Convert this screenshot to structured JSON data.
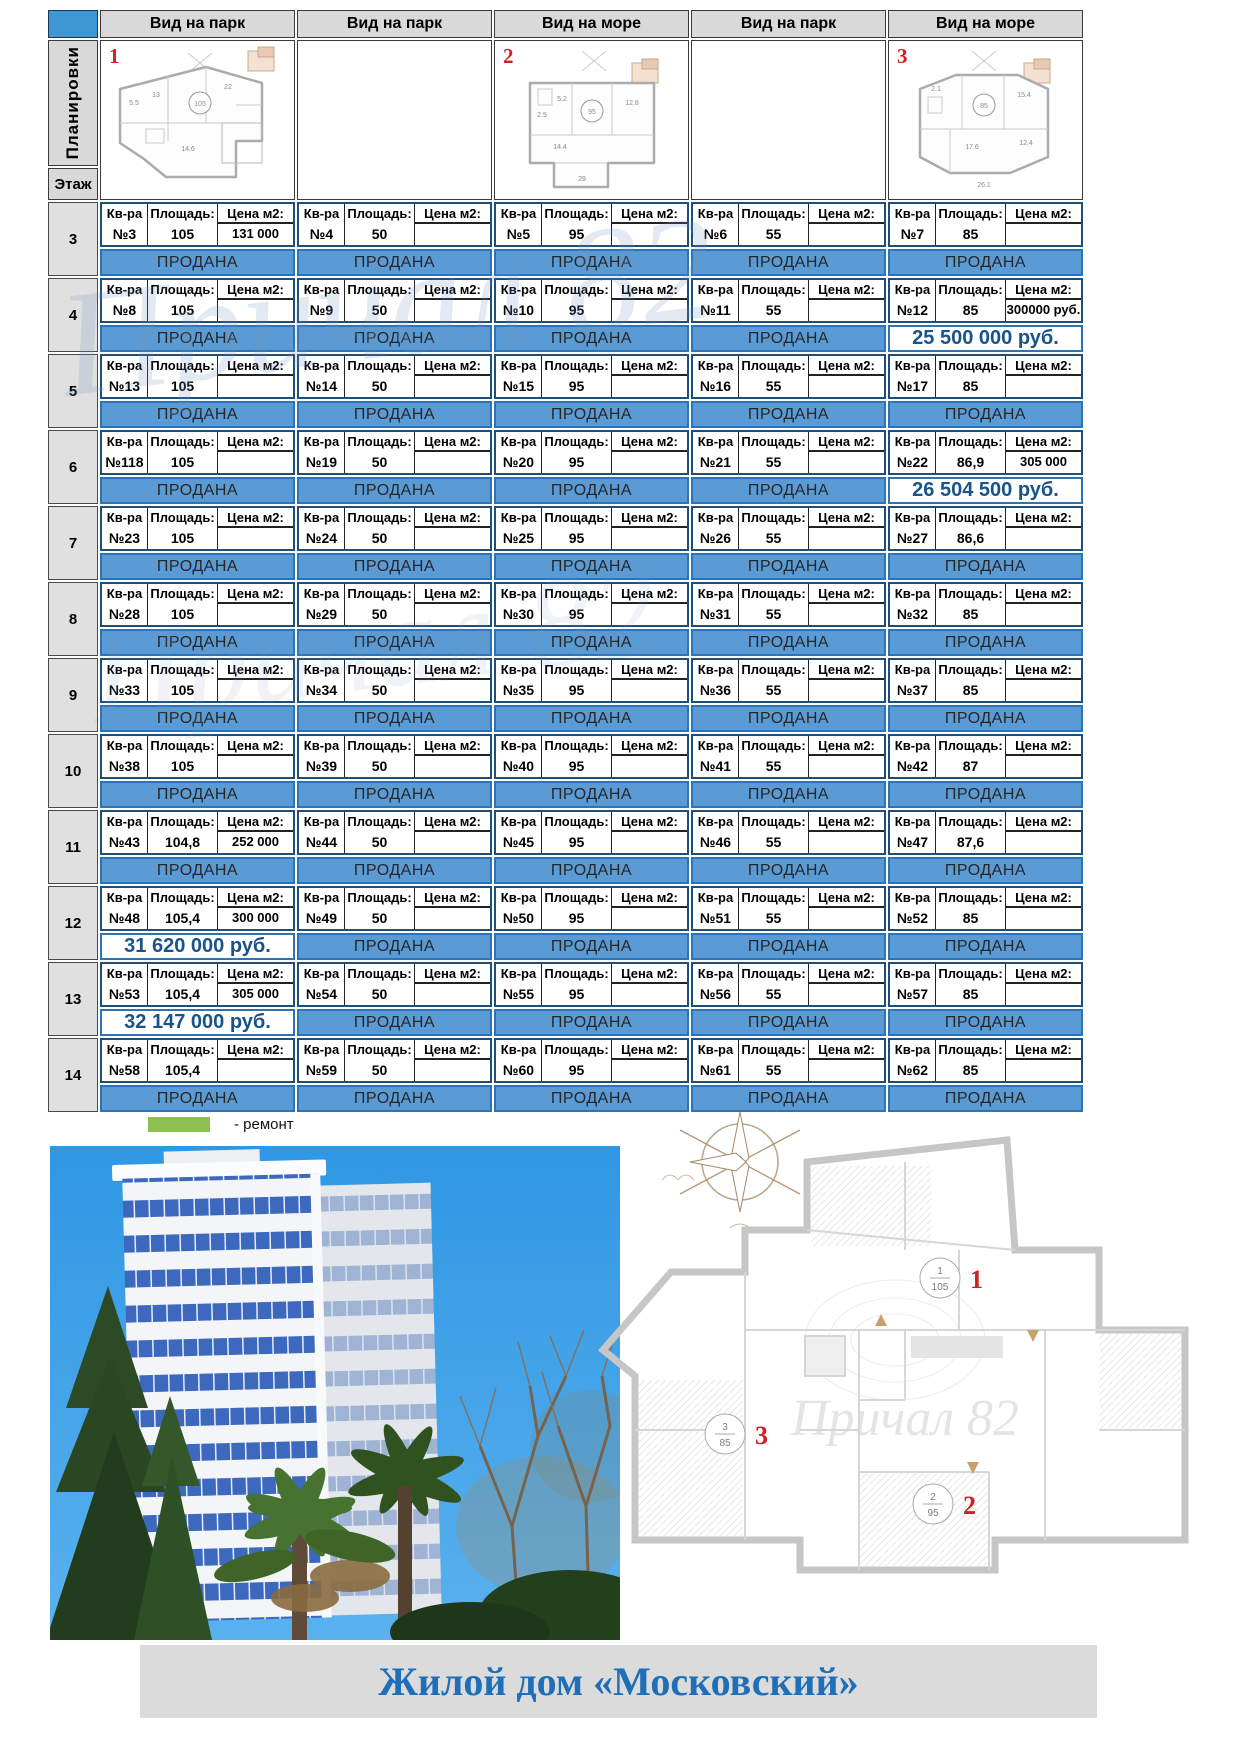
{
  "table": {
    "plans_label": "Планировки",
    "floor_label": "Этаж",
    "column_headers": [
      "Вид на парк",
      "Вид на парк",
      "Вид на море",
      "Вид на парк",
      "Вид на море"
    ],
    "plan_numbers": [
      "1",
      "2",
      "3"
    ],
    "plan_thumbs": [
      {
        "marker": "1",
        "area": "105"
      },
      {
        "marker": "2",
        "area": "95"
      },
      {
        "marker": "3",
        "area": "85"
      }
    ],
    "cell_header": {
      "apt": "Кв-ра",
      "area": "Площадь:",
      "price_m2": "Цена м2:"
    },
    "sold_label": "ПРОДАНА",
    "floors": [
      {
        "floor": "3",
        "apartments": [
          {
            "num": "№3",
            "area": "105",
            "price_m2": "131 000",
            "status": "ПРОДАНА",
            "sold": true
          },
          {
            "num": "№4",
            "area": "50",
            "price_m2": "",
            "status": "ПРОДАНА",
            "sold": true
          },
          {
            "num": "№5",
            "area": "95",
            "price_m2": "",
            "status": "ПРОДАНА",
            "sold": true
          },
          {
            "num": "№6",
            "area": "55",
            "price_m2": "",
            "status": "ПРОДАНА",
            "sold": true
          },
          {
            "num": "№7",
            "area": "85",
            "price_m2": "",
            "status": "ПРОДАНА",
            "sold": true
          }
        ]
      },
      {
        "floor": "4",
        "apartments": [
          {
            "num": "№8",
            "area": "105",
            "price_m2": "",
            "status": "ПРОДАНА",
            "sold": true
          },
          {
            "num": "№9",
            "area": "50",
            "price_m2": "",
            "status": "ПРОДАНА",
            "sold": true
          },
          {
            "num": "№10",
            "area": "95",
            "price_m2": "",
            "status": "ПРОДАНА",
            "sold": true
          },
          {
            "num": "№11",
            "area": "55",
            "price_m2": "",
            "status": "ПРОДАНА",
            "sold": true
          },
          {
            "num": "№12",
            "area": "85",
            "price_m2": "300000 руб.",
            "status": "25 500 000 руб.",
            "sold": false
          }
        ]
      },
      {
        "floor": "5",
        "apartments": [
          {
            "num": "№13",
            "area": "105",
            "price_m2": "",
            "status": "ПРОДАНА",
            "sold": true
          },
          {
            "num": "№14",
            "area": "50",
            "price_m2": "",
            "status": "ПРОДАНА",
            "sold": true
          },
          {
            "num": "№15",
            "area": "95",
            "price_m2": "",
            "status": "ПРОДАНА",
            "sold": true
          },
          {
            "num": "№16",
            "area": "55",
            "price_m2": "",
            "status": "ПРОДАНА",
            "sold": true
          },
          {
            "num": "№17",
            "area": "85",
            "price_m2": "",
            "status": "ПРОДАНА",
            "sold": true
          }
        ]
      },
      {
        "floor": "6",
        "apartments": [
          {
            "num": "№118",
            "area": "105",
            "price_m2": "",
            "status": "ПРОДАНА",
            "sold": true
          },
          {
            "num": "№19",
            "area": "50",
            "price_m2": "",
            "status": "ПРОДАНА",
            "sold": true
          },
          {
            "num": "№20",
            "area": "95",
            "price_m2": "",
            "status": "ПРОДАНА",
            "sold": true
          },
          {
            "num": "№21",
            "area": "55",
            "price_m2": "",
            "status": "ПРОДАНА",
            "sold": true
          },
          {
            "num": "№22",
            "area": "86,9",
            "price_m2": "305 000",
            "status": "26 504 500 руб.",
            "sold": false
          }
        ]
      },
      {
        "floor": "7",
        "apartments": [
          {
            "num": "№23",
            "area": "105",
            "price_m2": "",
            "status": "ПРОДАНА",
            "sold": true
          },
          {
            "num": "№24",
            "area": "50",
            "price_m2": "",
            "status": "ПРОДАНА",
            "sold": true
          },
          {
            "num": "№25",
            "area": "95",
            "price_m2": "",
            "status": "ПРОДАНА",
            "sold": true
          },
          {
            "num": "№26",
            "area": "55",
            "price_m2": "",
            "status": "ПРОДАНА",
            "sold": true
          },
          {
            "num": "№27",
            "area": "86,6",
            "price_m2": "",
            "status": "ПРОДАНА",
            "sold": true
          }
        ]
      },
      {
        "floor": "8",
        "apartments": [
          {
            "num": "№28",
            "area": "105",
            "price_m2": "",
            "status": "ПРОДАНА",
            "sold": true
          },
          {
            "num": "№29",
            "area": "50",
            "price_m2": "",
            "status": "ПРОДАНА",
            "sold": true
          },
          {
            "num": "№30",
            "area": "95",
            "price_m2": "",
            "status": "ПРОДАНА",
            "sold": true
          },
          {
            "num": "№31",
            "area": "55",
            "price_m2": "",
            "status": "ПРОДАНА",
            "sold": true
          },
          {
            "num": "№32",
            "area": "85",
            "price_m2": "",
            "status": "ПРОДАНА",
            "sold": true
          }
        ]
      },
      {
        "floor": "9",
        "apartments": [
          {
            "num": "№33",
            "area": "105",
            "price_m2": "",
            "status": "ПРОДАНА",
            "sold": true
          },
          {
            "num": "№34",
            "area": "50",
            "price_m2": "",
            "status": "ПРОДАНА",
            "sold": true
          },
          {
            "num": "№35",
            "area": "95",
            "price_m2": "",
            "status": "ПРОДАНА",
            "sold": true
          },
          {
            "num": "№36",
            "area": "55",
            "price_m2": "",
            "status": "ПРОДАНА",
            "sold": true
          },
          {
            "num": "№37",
            "area": "85",
            "price_m2": "",
            "status": "ПРОДАНА",
            "sold": true
          }
        ]
      },
      {
        "floor": "10",
        "apartments": [
          {
            "num": "№38",
            "area": "105",
            "price_m2": "",
            "status": "ПРОДАНА",
            "sold": true
          },
          {
            "num": "№39",
            "area": "50",
            "price_m2": "",
            "status": "ПРОДАНА",
            "sold": true
          },
          {
            "num": "№40",
            "area": "95",
            "price_m2": "",
            "status": "ПРОДАНА",
            "sold": true
          },
          {
            "num": "№41",
            "area": "55",
            "price_m2": "",
            "status": "ПРОДАНА",
            "sold": true
          },
          {
            "num": "№42",
            "area": "87",
            "price_m2": "",
            "status": "ПРОДАНА",
            "sold": true
          }
        ]
      },
      {
        "floor": "11",
        "apartments": [
          {
            "num": "№43",
            "area": "104,8",
            "price_m2": "252 000",
            "status": "ПРОДАНА",
            "sold": true
          },
          {
            "num": "№44",
            "area": "50",
            "price_m2": "",
            "status": "ПРОДАНА",
            "sold": true
          },
          {
            "num": "№45",
            "area": "95",
            "price_m2": "",
            "status": "ПРОДАНА",
            "sold": true
          },
          {
            "num": "№46",
            "area": "55",
            "price_m2": "",
            "status": "ПРОДАНА",
            "sold": true
          },
          {
            "num": "№47",
            "area": "87,6",
            "price_m2": "",
            "status": "ПРОДАНА",
            "sold": true
          }
        ]
      },
      {
        "floor": "12",
        "apartments": [
          {
            "num": "№48",
            "area": "105,4",
            "price_m2": "300 000",
            "status": "31 620 000 руб.",
            "sold": false
          },
          {
            "num": "№49",
            "area": "50",
            "price_m2": "",
            "status": "ПРОДАНА",
            "sold": true
          },
          {
            "num": "№50",
            "area": "95",
            "price_m2": "",
            "status": "ПРОДАНА",
            "sold": true
          },
          {
            "num": "№51",
            "area": "55",
            "price_m2": "",
            "status": "ПРОДАНА",
            "sold": true
          },
          {
            "num": "№52",
            "area": "85",
            "price_m2": "",
            "status": "ПРОДАНА",
            "sold": true
          }
        ]
      },
      {
        "floor": "13",
        "apartments": [
          {
            "num": "№53",
            "area": "105,4",
            "price_m2": "305 000",
            "status": "32 147 000 руб.",
            "sold": false
          },
          {
            "num": "№54",
            "area": "50",
            "price_m2": "",
            "status": "ПРОДАНА",
            "sold": true
          },
          {
            "num": "№55",
            "area": "95",
            "price_m2": "",
            "status": "ПРОДАНА",
            "sold": true
          },
          {
            "num": "№56",
            "area": "55",
            "price_m2": "",
            "status": "ПРОДАНА",
            "sold": true
          },
          {
            "num": "№57",
            "area": "85",
            "price_m2": "",
            "status": "ПРОДАНА",
            "sold": true
          }
        ]
      },
      {
        "floor": "14",
        "apartments": [
          {
            "num": "№58",
            "area": "105,4",
            "price_m2": "",
            "status": "ПРОДАНА",
            "sold": true
          },
          {
            "num": "№59",
            "area": "50",
            "price_m2": "",
            "status": "ПРОДАНА",
            "sold": true
          },
          {
            "num": "№60",
            "area": "95",
            "price_m2": "",
            "status": "ПРОДАНА",
            "sold": true
          },
          {
            "num": "№61",
            "area": "55",
            "price_m2": "",
            "status": "ПРОДАНА",
            "sold": true
          },
          {
            "num": "№62",
            "area": "85",
            "price_m2": "",
            "status": "ПРОДАНА",
            "sold": true
          }
        ]
      }
    ]
  },
  "legend": {
    "label": "-  ремонт"
  },
  "watermark": "Причал 82",
  "floor_plan": {
    "watermark": "Причал 82",
    "markers": [
      {
        "red": "1",
        "circle_top": "1",
        "circle_bottom": "105"
      },
      {
        "red": "2",
        "circle_top": "2",
        "circle_bottom": "95"
      },
      {
        "red": "3",
        "circle_top": "3",
        "circle_bottom": "85"
      }
    ]
  },
  "footer": {
    "title": "Жилой дом «Московский»"
  },
  "colors": {
    "sold_bar": "#5B9BD5",
    "sold_border": "#2E74B5",
    "price_text": "#17548C",
    "header_bg": "#D9D9D9",
    "corner_blue": "#3E96D2",
    "legend_green": "#8CC152",
    "title_blue": "#1F6FB8",
    "marker_red": "#CC2222"
  }
}
